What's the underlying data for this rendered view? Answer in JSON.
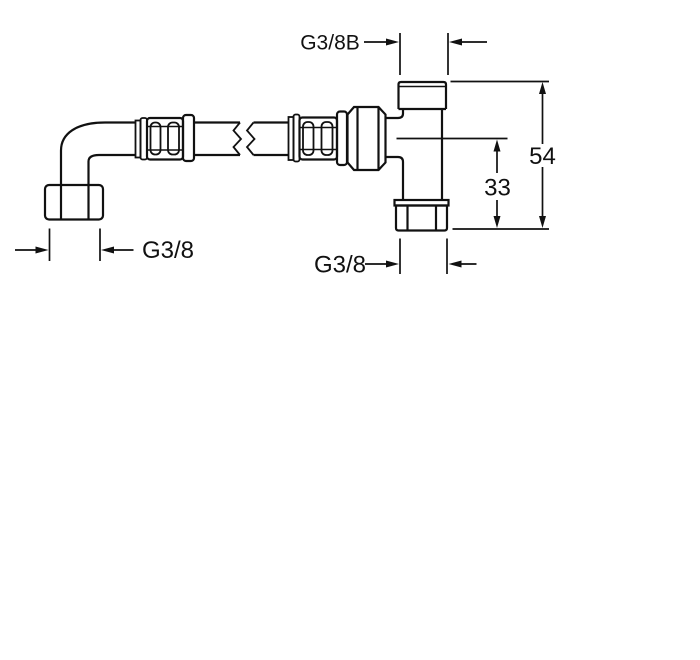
{
  "drawing": {
    "description": "flexible-hose-with-elbow-and-tee-valve-dimension-drawing",
    "background_color": "#ffffff",
    "line_color": "#111111",
    "labels": {
      "top_thread": "G3/8B",
      "total_height": "54",
      "outlet_height": "33",
      "outlet_thread": "G3/8",
      "elbow_thread": "G3/8"
    }
  }
}
